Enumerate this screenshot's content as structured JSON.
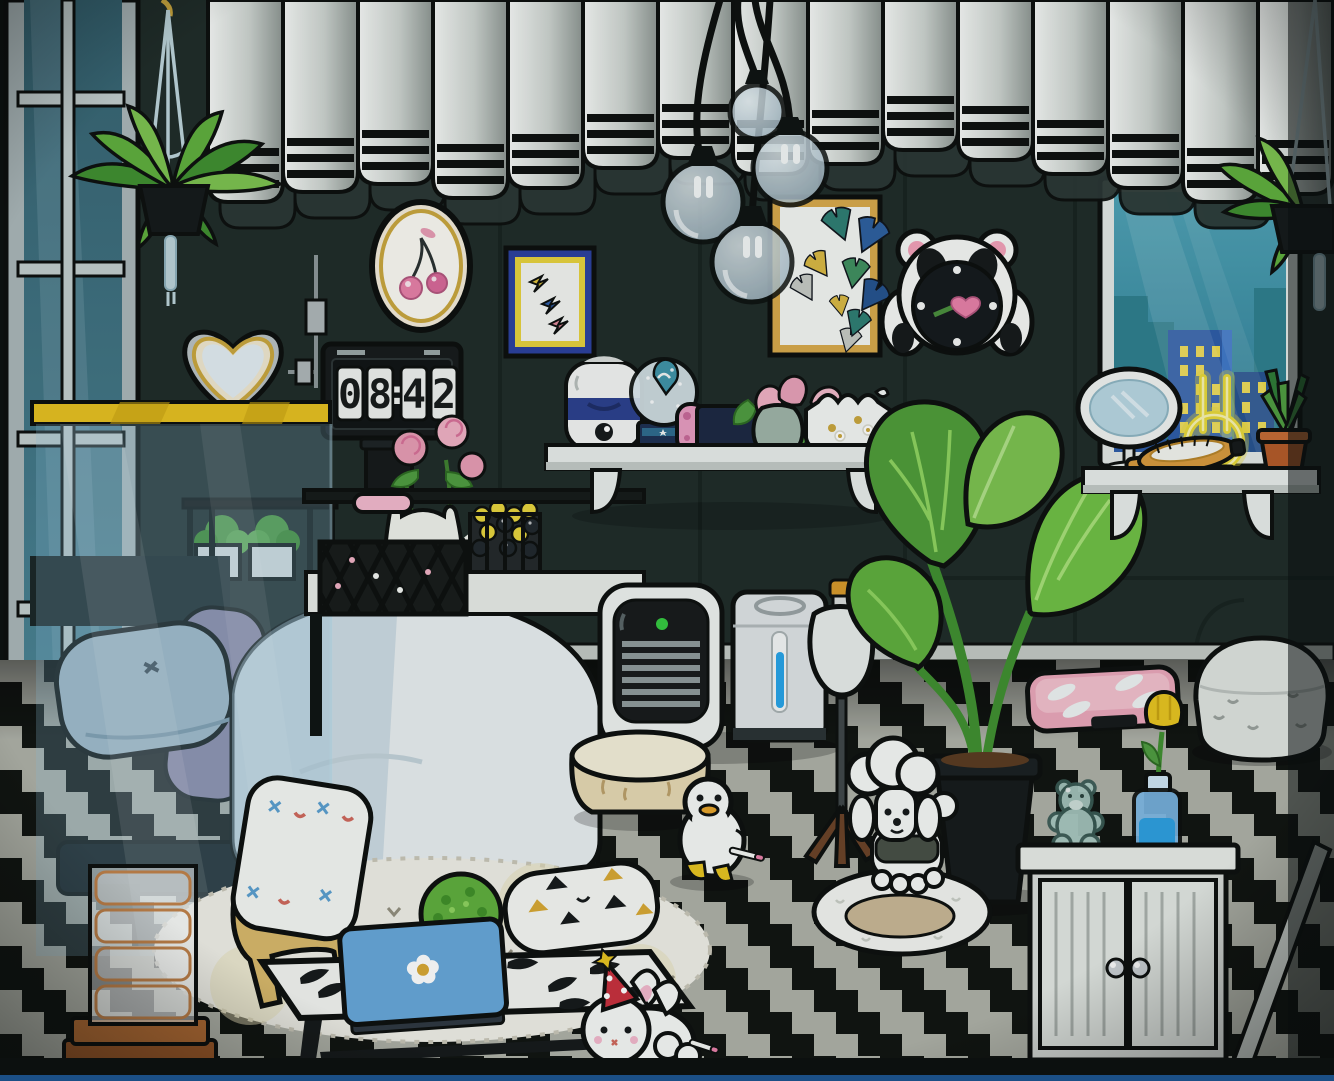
{
  "scene": {
    "type": "game-room-screenshot",
    "style": "toca-life-world",
    "description": "black and white bedroom at night with checkered zigzag floor"
  },
  "clock": {
    "display": "08:42",
    "h1": "0",
    "h2": "8",
    "sep": ":",
    "m1": "4",
    "m2": "2"
  },
  "palette": {
    "wall": "#1f2b28",
    "floor_light": "#aeb0a7",
    "floor_dark": "#101310",
    "curtain_white": "#eef0ec",
    "glass_teal": "#3f93a8",
    "accent_yellow": "#e6bf1f",
    "neon_yellow": "#e8d838",
    "plant_green": "#57a33c",
    "laptop_blue": "#5fa0d8",
    "joycon_pink": "#e89cc0",
    "joycon_blue": "#3ec8e0",
    "led_green": "#35c93f",
    "scale_pink": "#f0a8bc",
    "water_blue": "#27a3e8",
    "wood_tan": "#d8b86a",
    "brush_wood": "#d89a3c",
    "frame_gold": "#d8a94a"
  },
  "curtain": {
    "start_x": 208,
    "fold_width": 75,
    "fold_heights": [
      202,
      192,
      184,
      198,
      188,
      168,
      158,
      174,
      164,
      150,
      160,
      174,
      188,
      202,
      194,
      186
    ]
  },
  "inventory": [
    "left-window",
    "striped-curtain-valance",
    "hanging-plant-left",
    "hanging-plant-right",
    "pendant-glass-lights",
    "cherry-oval-frame",
    "heart-mirror-lamp",
    "pull-cord-switch",
    "lightning-bolt-poster",
    "flip-clock",
    "black-canister",
    "ginkgo-poster",
    "panda-wall-clock",
    "wall-shelf",
    "mini-humidifier",
    "snow-globe",
    "game-console",
    "tulip-vase",
    "trinket-box",
    "yellow-rail",
    "sheer-light-curtain",
    "headboard-planter-railing",
    "black-crib-console",
    "rose-vase-cat",
    "fruit-baskets",
    "pink-blanket",
    "heart-finial",
    "bed",
    "blue-pillow",
    "purple-pillow",
    "white-duvet",
    "air-purifier",
    "humidifier-tank",
    "dress-form-mannequin",
    "monstera-pot-plant",
    "baseboard",
    "right-window-city-view",
    "vanity-shelf",
    "table-mirror",
    "neon-bunny-lamp",
    "hairbrush",
    "small-potted-plant",
    "pink-body-scale",
    "knitted-pouf",
    "glass-teddy-bear",
    "tulip-bottle-vase",
    "white-cabinet",
    "leaning-stick",
    "pet-bed",
    "toy-poodle",
    "duck-toy",
    "cream-stool",
    "big-round-rug",
    "triangle-pillow",
    "zebra-coffee-table",
    "blue-laptop",
    "topiary-ball",
    "wooden-armchair",
    "x-stitch-cushion",
    "drawer-tower",
    "bunny-plush-party-hat",
    "checkered-floor"
  ]
}
